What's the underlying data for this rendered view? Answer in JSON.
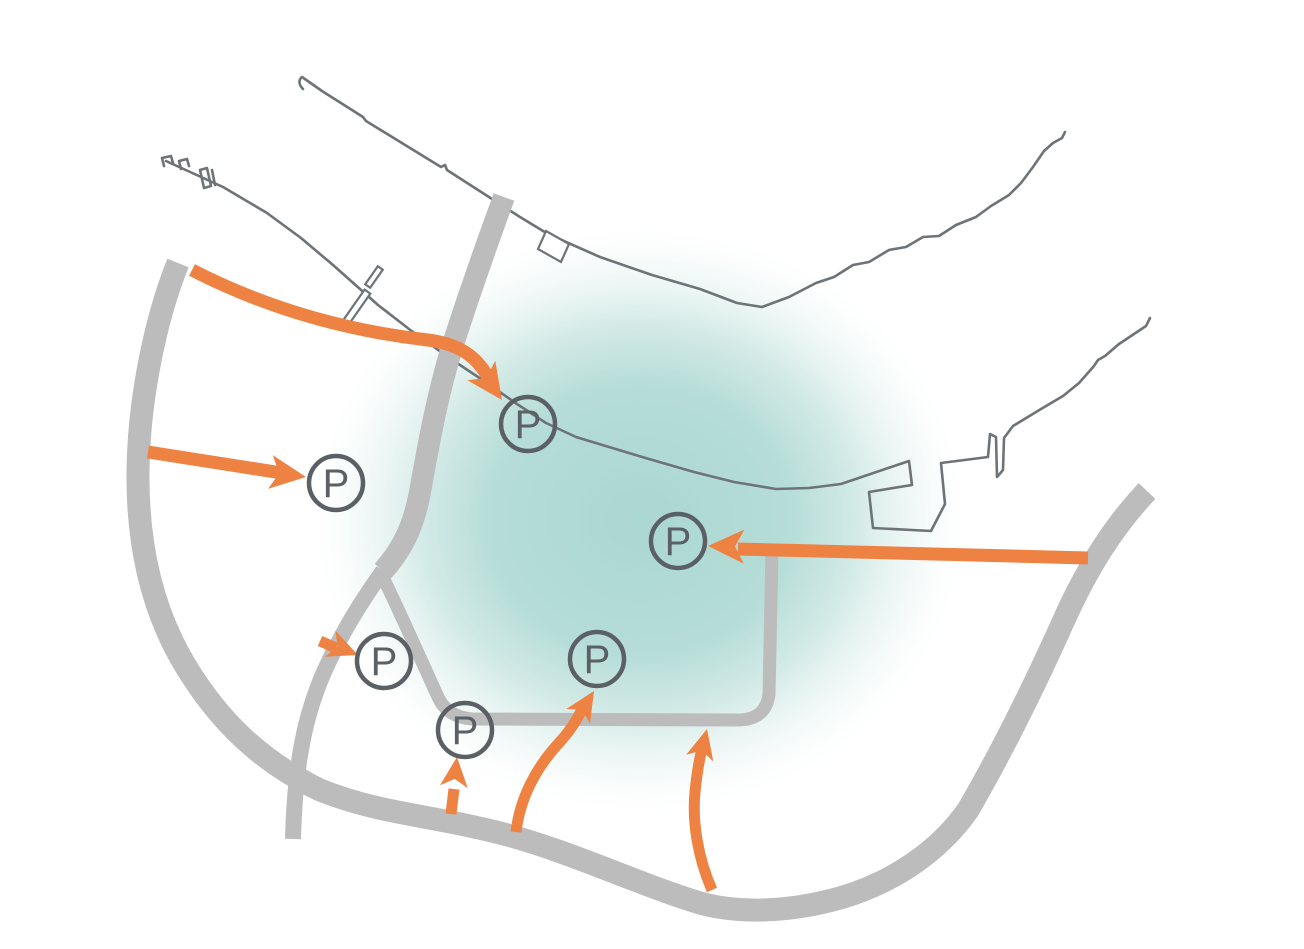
{
  "map": {
    "kind": "parking-access-schematic",
    "symbol_letter": "P"
  },
  "colors": {
    "background": "#FFFFFF",
    "accent_orange": "#EE8243",
    "road_gray": "#BCBCBC",
    "coast_gray": "#6E7377",
    "symbol_gray": "#5A6064",
    "zone_teal": "#A9D7D0"
  },
  "markers": [
    {
      "id": "p-waterfront",
      "label": "P",
      "x": 528,
      "y": 424
    },
    {
      "id": "p-west",
      "label": "P",
      "x": 336,
      "y": 483
    },
    {
      "id": "p-east",
      "label": "P",
      "x": 678,
      "y": 541
    },
    {
      "id": "p-center-west",
      "label": "P",
      "x": 384,
      "y": 661
    },
    {
      "id": "p-loop-corner",
      "label": "P",
      "x": 465,
      "y": 730
    },
    {
      "id": "p-center-south",
      "label": "P",
      "x": 597,
      "y": 659
    }
  ],
  "arrows": [
    {
      "name": "access-arrow-northwest",
      "points_to": "p-waterfront"
    },
    {
      "name": "access-arrow-west",
      "points_to": "p-west"
    },
    {
      "name": "access-arrow-east",
      "points_to": "p-east"
    },
    {
      "name": "access-arrow-center-west",
      "points_to": "p-center-west"
    },
    {
      "name": "access-arrow-south-vertical",
      "points_to": "p-loop-corner"
    },
    {
      "name": "access-arrow-south-curved",
      "points_to": "p-center-south"
    },
    {
      "name": "access-arrow-southeast-curved",
      "points_to": "inner-loop"
    }
  ]
}
